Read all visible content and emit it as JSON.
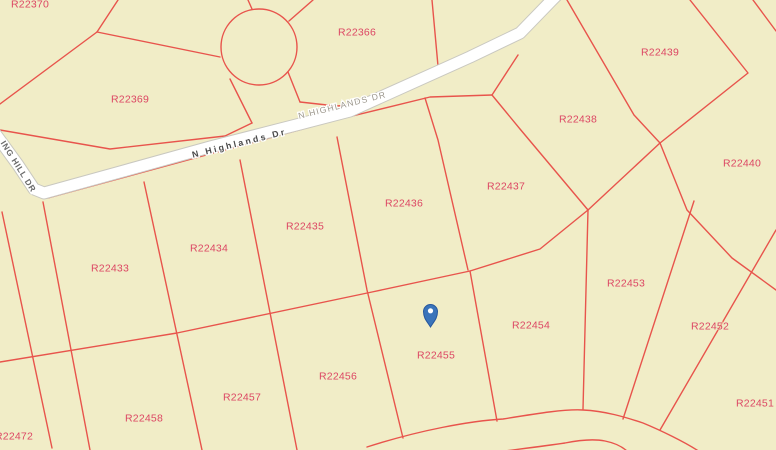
{
  "map": {
    "type": "parcel-map-viewer",
    "background_color": "#f1edc7",
    "parcel_line_color": "#e8544c",
    "parcel_label_color": "#dc4663",
    "road_fill_color": "#ffffff",
    "road_casing_color": "#c9c8c0",
    "marker": {
      "name": "location-marker",
      "parcel": "R22455",
      "x": 430.5,
      "y": 315,
      "body_color": "#3a74ba",
      "outline_color": "#26579d",
      "dot_color": "#ffffff"
    },
    "roads": [
      {
        "label": "N Highlands Dr",
        "style": "primary",
        "x": 240,
        "y": 146,
        "rotate": -14
      },
      {
        "label": "N HIGHLANDS DR",
        "style": "secondary",
        "x": 343,
        "y": 108,
        "rotate": -14
      },
      {
        "label": "ING HILL DR",
        "style": "side",
        "x": 16,
        "y": 168,
        "rotate": 58
      }
    ],
    "parcels": [
      {
        "id": "R22370",
        "x": 30,
        "y": 4
      },
      {
        "id": "R22369",
        "x": 130,
        "y": 99
      },
      {
        "id": "R22366",
        "x": 357,
        "y": 32
      },
      {
        "id": "R22439",
        "x": 660,
        "y": 52
      },
      {
        "id": "R22438",
        "x": 578,
        "y": 119
      },
      {
        "id": "R22440",
        "x": 742,
        "y": 163
      },
      {
        "id": "R22437",
        "x": 506,
        "y": 186
      },
      {
        "id": "R22436",
        "x": 404,
        "y": 203
      },
      {
        "id": "R22435",
        "x": 305,
        "y": 226
      },
      {
        "id": "R22434",
        "x": 209,
        "y": 248
      },
      {
        "id": "R22433",
        "x": 110,
        "y": 268
      },
      {
        "id": "R22453",
        "x": 626,
        "y": 283
      },
      {
        "id": "R22454",
        "x": 531,
        "y": 325
      },
      {
        "id": "R22452",
        "x": 710,
        "y": 326
      },
      {
        "id": "R22451",
        "x": 755,
        "y": 403
      },
      {
        "id": "R22455",
        "x": 436,
        "y": 355
      },
      {
        "id": "R22456",
        "x": 338,
        "y": 376
      },
      {
        "id": "R22457",
        "x": 242,
        "y": 397
      },
      {
        "id": "R22458",
        "x": 144,
        "y": 418
      },
      {
        "id": "R22472",
        "x": 14,
        "y": 436
      }
    ]
  }
}
